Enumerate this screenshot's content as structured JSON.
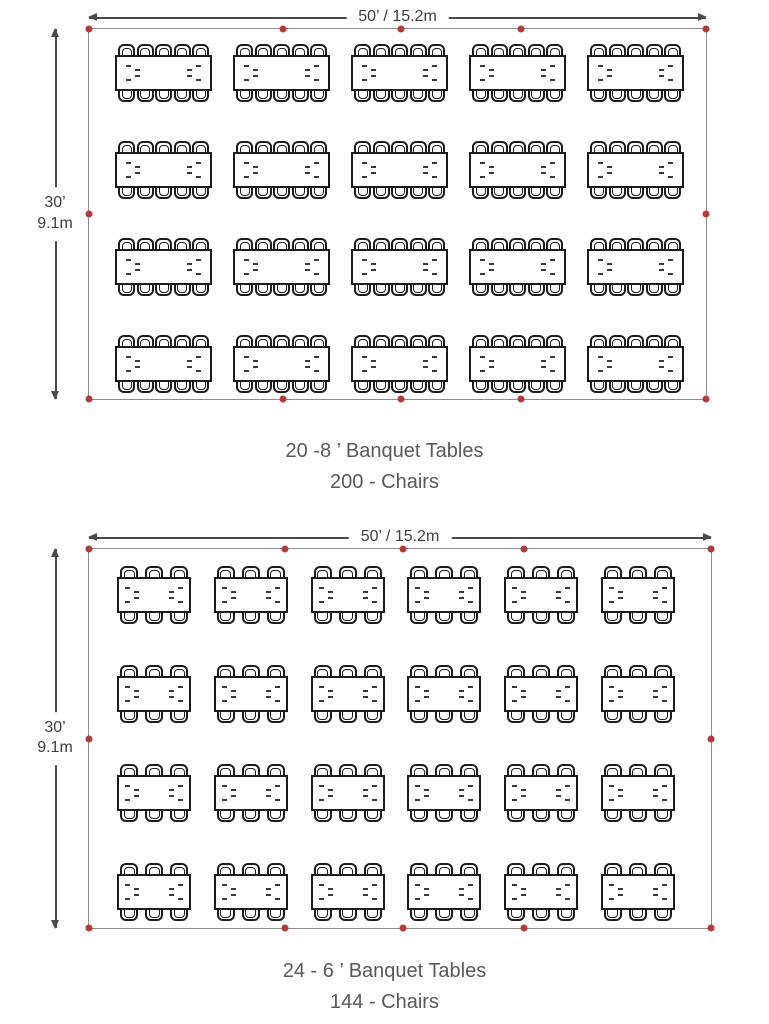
{
  "colors": {
    "outline_gray": "#8d8d8d",
    "dimension_line": "#4a4a4c",
    "table_line": "#1c1c1c",
    "stake_dot_red": "#b23a3a",
    "caption_text": "#58595b"
  },
  "diagrams": [
    {
      "id": "layout-8ft",
      "width_label": "50’ / 15.2m",
      "height_label_ft": "30’",
      "height_label_m": "9.1m",
      "caption_line1": "20 -8 ’ Banquet Tables",
      "caption_line2": "200 - Chairs",
      "rows": 4,
      "columns": 5,
      "table_length_ft": 8,
      "chairs_per_side": 5,
      "chairs_per_table": 10,
      "total_tables": 20,
      "total_chairs": 200
    },
    {
      "id": "layout-6ft",
      "width_label": "50’ / 15.2m",
      "height_label_ft": "30’",
      "height_label_m": "9.1m",
      "caption_line1": "24 - 6 ’ Banquet Tables",
      "caption_line2": "144 - Chairs",
      "rows": 4,
      "columns": 6,
      "table_length_ft": 6,
      "chairs_per_side": 3,
      "chairs_per_table": 6,
      "total_tables": 24,
      "total_chairs": 144
    }
  ]
}
